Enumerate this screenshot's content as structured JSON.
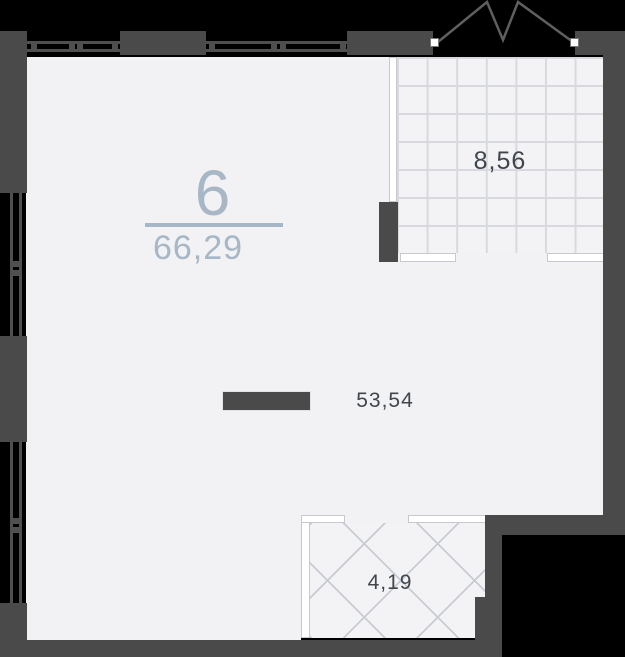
{
  "plan": {
    "type": "apartment-floor-plan",
    "unit": {
      "number": "6",
      "total_area": "66,29"
    },
    "rooms": {
      "main": {
        "name": "main-room",
        "area": "53,54"
      },
      "loggia": {
        "name": "loggia-grid",
        "area": "8,56"
      },
      "balcony": {
        "name": "balcony-hatched",
        "area": "4,19"
      }
    },
    "colors": {
      "wall": "#4a4a4a",
      "floor": "#f2f2f4",
      "outside_background": "#000000",
      "unit_accent": "#a7b7c6",
      "area_label": "#41454c",
      "grid_line": "#d8d9de",
      "hatch_line": "#c9cbd2",
      "window_frame": "#ffffff"
    }
  }
}
